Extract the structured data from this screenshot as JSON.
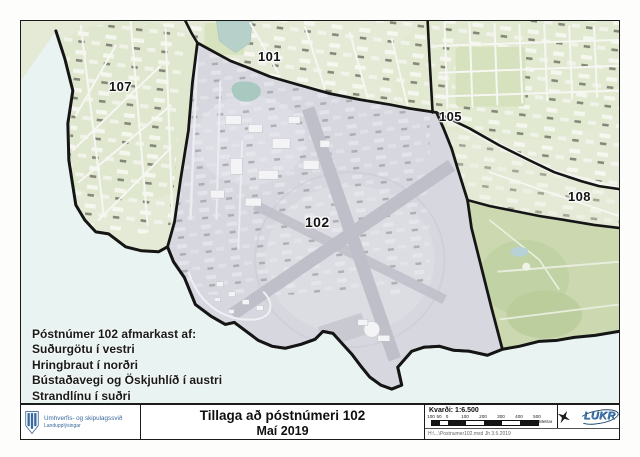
{
  "map": {
    "region_labels": {
      "r101": "101",
      "r102": "102",
      "r105": "105",
      "r107": "107",
      "r108": "108"
    },
    "note_lines": [
      "Póstnúmer 102 afmarkast af:",
      "Suðurgötu í vestri",
      "Hringbraut í norðri",
      "Bústaðavegi og Öskjuhlíð í austri",
      "Strandlínu í suðri"
    ]
  },
  "footer": {
    "agency": {
      "name": "Umhverfis- og skipulagssvið",
      "department": "Landupplýsingar"
    },
    "title_line1": "Tillaga að póstnúmeri 102",
    "title_line2": "Maí 2019",
    "scale": {
      "label": "Kvarði: 1:6.500",
      "ticks": [
        "100",
        "50",
        "0",
        "100",
        "200",
        "300",
        "400",
        "500"
      ],
      "unit": "Metrar"
    },
    "credits": "H:\\...\\Postnumer102.mxd Jh 3.5.2019",
    "logo_text": "LUKR"
  },
  "colors": {
    "district_fill": "#d7d7df",
    "land_green": "#e4ead6",
    "sea": "#e9f3f1",
    "boundary_black": "#151515",
    "agency_blue": "#39699c",
    "lukr_blue": "#3b76b3"
  }
}
